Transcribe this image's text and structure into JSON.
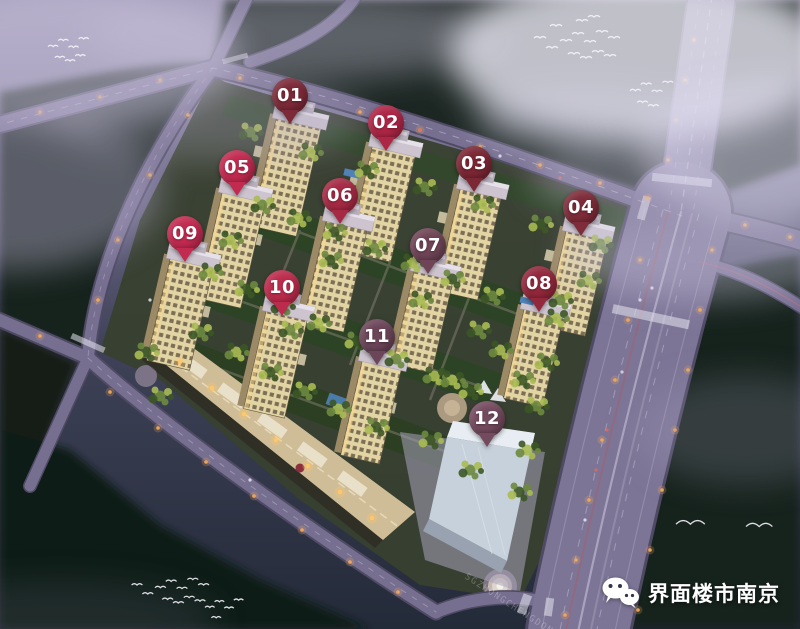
{
  "markers": [
    {
      "label": "01",
      "x": 290,
      "y": 96,
      "color": "#7d2a38"
    },
    {
      "label": "02",
      "x": 386,
      "y": 123,
      "color": "#ae2646"
    },
    {
      "label": "03",
      "x": 474,
      "y": 164,
      "color": "#7c2734"
    },
    {
      "label": "04",
      "x": 581,
      "y": 208,
      "color": "#7e2c39"
    },
    {
      "label": "05",
      "x": 237,
      "y": 168,
      "color": "#c22a50"
    },
    {
      "label": "06",
      "x": 340,
      "y": 196,
      "color": "#a62a44"
    },
    {
      "label": "07",
      "x": 428,
      "y": 246,
      "color": "#6f4456"
    },
    {
      "label": "08",
      "x": 539,
      "y": 284,
      "color": "#93283c"
    },
    {
      "label": "09",
      "x": 185,
      "y": 234,
      "color": "#c22a50"
    },
    {
      "label": "10",
      "x": 282,
      "y": 288,
      "color": "#bc2b4c"
    },
    {
      "label": "11",
      "x": 377,
      "y": 337,
      "color": "#6b4558"
    },
    {
      "label": "12",
      "x": 487,
      "y": 419,
      "color": "#744a5e"
    }
  ],
  "watermark": {
    "icon": "wechat-icon",
    "text": "界面楼市南京",
    "text_color": "#ffffff"
  },
  "road_watermark": {
    "text": "SGZHONGCHENGDONGCAI",
    "opacity": 0.26
  },
  "palette": {
    "sky_top": "#9d96b4",
    "sky_mid": "#3f4258",
    "sky_bottom": "#232a38",
    "forest": "#16211a",
    "site_ground": "#38402f",
    "road_fill": "#776f90",
    "road_casing": "#4f4a64",
    "lane_mark": "#cfc9e0",
    "tower_facade": "#e3d4a4",
    "tower_roof": "#cdc4cf",
    "tower_window": "#4e4434",
    "tree_mid": "#6d8a3f",
    "tree_light": "#a9bb52",
    "tree_dark": "#3c5626",
    "streetlight": "#f2a85c",
    "strip_light": "#ffc66a",
    "bird": "#f4f2f8",
    "fog": "#dedaf0"
  }
}
